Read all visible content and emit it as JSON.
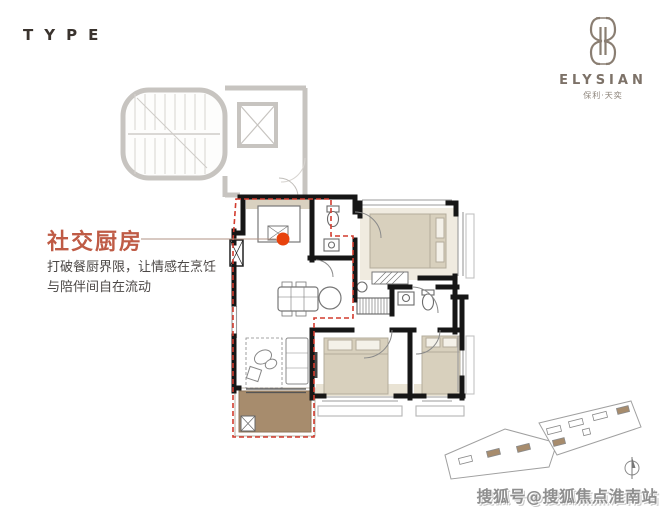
{
  "header": {
    "type_label": "TYPE"
  },
  "brand": {
    "emblem_icon": "elysian-emblem-icon",
    "name": "ELYSIAN",
    "subtitle": "保利·天奕"
  },
  "callout": {
    "title": "社交厨房",
    "description_line1": "打破餐厨界限，让情感在烹饪",
    "description_line2": "与陪伴间自在流动"
  },
  "floor_plan": {
    "marker": "kitchen-highlight-dot",
    "highlight_zone": "kitchen-dining-living-balcony"
  },
  "site_plan": {
    "north_indicator": "north-arrow-icon"
  },
  "watermark": {
    "text": "搜狐号@搜狐焦点淮南站"
  },
  "colors": {
    "title_accent": "#bf5b45",
    "marker_red": "#e8430d",
    "zone_dash_red": "#d23b2e",
    "balcony_brown": "#a78c6d",
    "core_gray": "#c7c4c0",
    "wall_black": "#161616",
    "bed_beige": "#d8d0bd",
    "brand_brown": "#7d7268",
    "body_text": "#4c4846",
    "watermark_gray": "#8f8f8f"
  }
}
